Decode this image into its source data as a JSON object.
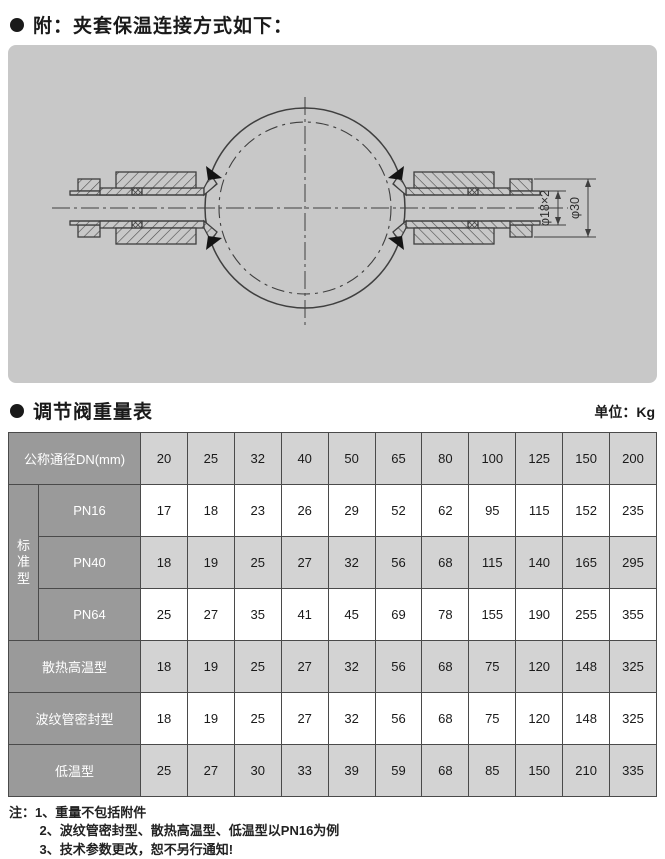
{
  "attachment_section": {
    "title": "附：夹套保温连接方式如下："
  },
  "drawing": {
    "dim_inner_label": "φ18×2",
    "dim_outer_label": "φ30"
  },
  "weight_section": {
    "title": "调节阀重量表",
    "unit": "单位：Kg"
  },
  "table": {
    "corner_header": "公称通径DN(mm)",
    "dn_columns": [
      "20",
      "25",
      "32",
      "40",
      "50",
      "65",
      "80",
      "100",
      "125",
      "150",
      "200"
    ],
    "group_label": "标准型",
    "rows": [
      {
        "label": "PN16",
        "in_group": true,
        "shaded": false,
        "values": [
          "17",
          "18",
          "23",
          "26",
          "29",
          "52",
          "62",
          "95",
          "115",
          "152",
          "235"
        ]
      },
      {
        "label": "PN40",
        "in_group": true,
        "shaded": true,
        "values": [
          "18",
          "19",
          "25",
          "27",
          "32",
          "56",
          "68",
          "115",
          "140",
          "165",
          "295"
        ]
      },
      {
        "label": "PN64",
        "in_group": true,
        "shaded": false,
        "values": [
          "25",
          "27",
          "35",
          "41",
          "45",
          "69",
          "78",
          "155",
          "190",
          "255",
          "355"
        ]
      },
      {
        "label": "散热高温型",
        "in_group": false,
        "shaded": true,
        "values": [
          "18",
          "19",
          "25",
          "27",
          "32",
          "56",
          "68",
          "75",
          "120",
          "148",
          "325"
        ]
      },
      {
        "label": "波纹管密封型",
        "in_group": false,
        "shaded": false,
        "values": [
          "18",
          "19",
          "25",
          "27",
          "32",
          "56",
          "68",
          "75",
          "120",
          "148",
          "325"
        ]
      },
      {
        "label": "低温型",
        "in_group": false,
        "shaded": true,
        "values": [
          "25",
          "27",
          "30",
          "33",
          "39",
          "59",
          "68",
          "85",
          "150",
          "210",
          "335"
        ]
      }
    ]
  },
  "notes": {
    "prefix": "注：",
    "items": [
      "1、重量不包括附件",
      "2、波纹管密封型、散热高温型、低温型以PN16为例",
      "3、技术参数更改，恕不另行通知!"
    ]
  },
  "colors": {
    "panel_bg": "#c8c8c8",
    "header_dark": "#9a9a9a",
    "header_light": "#d3d3d3",
    "border": "#4a4a4a",
    "line": "#3f3f3f"
  }
}
